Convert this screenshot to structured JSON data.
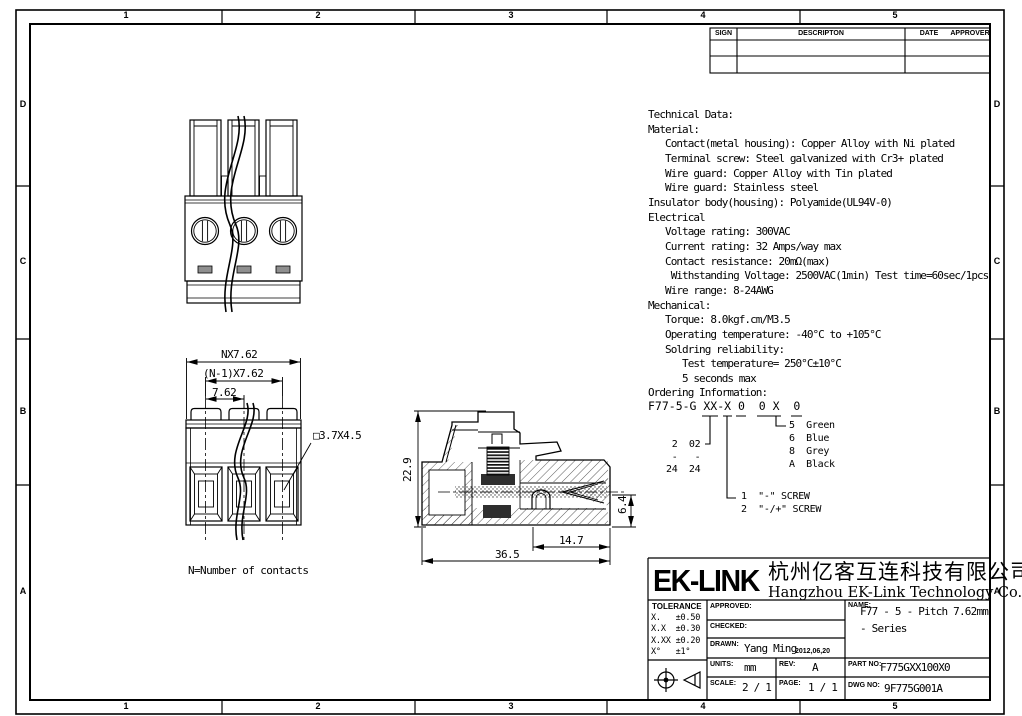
{
  "border": {
    "top_zones": [
      "1",
      "2",
      "3",
      "4",
      "5"
    ],
    "bottom_zones": [
      "1",
      "2",
      "3",
      "4",
      "5"
    ],
    "left_zones": [
      "D",
      "C",
      "B",
      "A"
    ],
    "right_zones": [
      "D",
      "C",
      "B",
      "A"
    ]
  },
  "revision_table": {
    "sign": "SIGN",
    "description": "DESCRIPTON",
    "date": "DATE",
    "approver": "APPROVER"
  },
  "tech_notes": {
    "lines": [
      "Technical Data:",
      "Material:",
      "   Contact(metal housing): Copper Alloy with Ni plated",
      "   Terminal screw: Steel galvanized with Cr3+ plated",
      "   Wire guard: Copper Alloy with Tin plated",
      "   Wire guard: Stainless steel",
      "Insulator body(housing): Polyamide(UL94V-0)",
      "Electrical",
      "   Voltage rating: 300VAC",
      "   Current rating: 32 Amps/way max",
      "   Contact resistance: 20mΩ(max)",
      "    Withstanding Voltage: 2500VAC(1min) Test time=60sec/1pcs",
      "   Wire range: 8-24AWG",
      "Mechanical:",
      "   Torque: 8.0kgf.cm/M3.5",
      "   Operating temperature: -40°C to +105°C",
      "   Soldring reliability:",
      "      Test temperature= 250°C±10°C",
      "      5 seconds max",
      "Ordering Information:"
    ]
  },
  "ordering": {
    "code": "F77-5-G XX-X 0  0 X  0",
    "ways_range": {
      "lines": [
        " 2  02",
        " -   -",
        "24  24"
      ]
    },
    "screw_options": {
      "lines": [
        "1  \"-\" SCREW",
        "2  \"-/+\" SCREW"
      ]
    },
    "color_options": {
      "lines": [
        "5  Green",
        "6  Blue",
        "8  Grey",
        "A  Black"
      ]
    }
  },
  "views": {
    "dim_nx762": "NX7.62",
    "dim_n1x762": "(N-1)X7.62",
    "dim_762": "7.62",
    "dim_square": "□3.7X4.5",
    "dim_229": "22.9",
    "dim_365": "36.5",
    "dim_147": "14.7",
    "dim_64": "6.4",
    "note_contacts": "N=Number of contacts"
  },
  "title_block": {
    "logo": "EK-LINK",
    "company_cn": "杭州亿客互连科技有限公司",
    "company_en": "Hangzhou EK-Link Technology Co.,Ltd",
    "tolerance_title": "TOLERANCE",
    "tolerance": {
      "lines": [
        "X.   ±0.50",
        "X.X  ±0.30",
        "X.XX ±0.20",
        "X°   ±1°"
      ]
    },
    "approved_label": "APPROVED:",
    "checked_label": "CHECKED:",
    "drawn_label": "DRAWN:",
    "drawn_value": "Yang Ming",
    "drawn_date": "2012,06,20",
    "units_label": "UNITS:",
    "units_value": "mm",
    "rev_label": "REV:",
    "rev_value": "A",
    "scale_label": "SCALE:",
    "scale_value": "2 / 1",
    "page_label": "PAGE:",
    "page_value": "1 / 1",
    "name_label": "NAME:",
    "name_value_line1": "F77 - 5 - Pitch 7.62mm",
    "name_value_line2": "- Series",
    "part_label": "PART NO:",
    "part_value": "F775GXX100X0",
    "dwg_label": "DWG NO:",
    "dwg_value": "9F775G001A"
  }
}
